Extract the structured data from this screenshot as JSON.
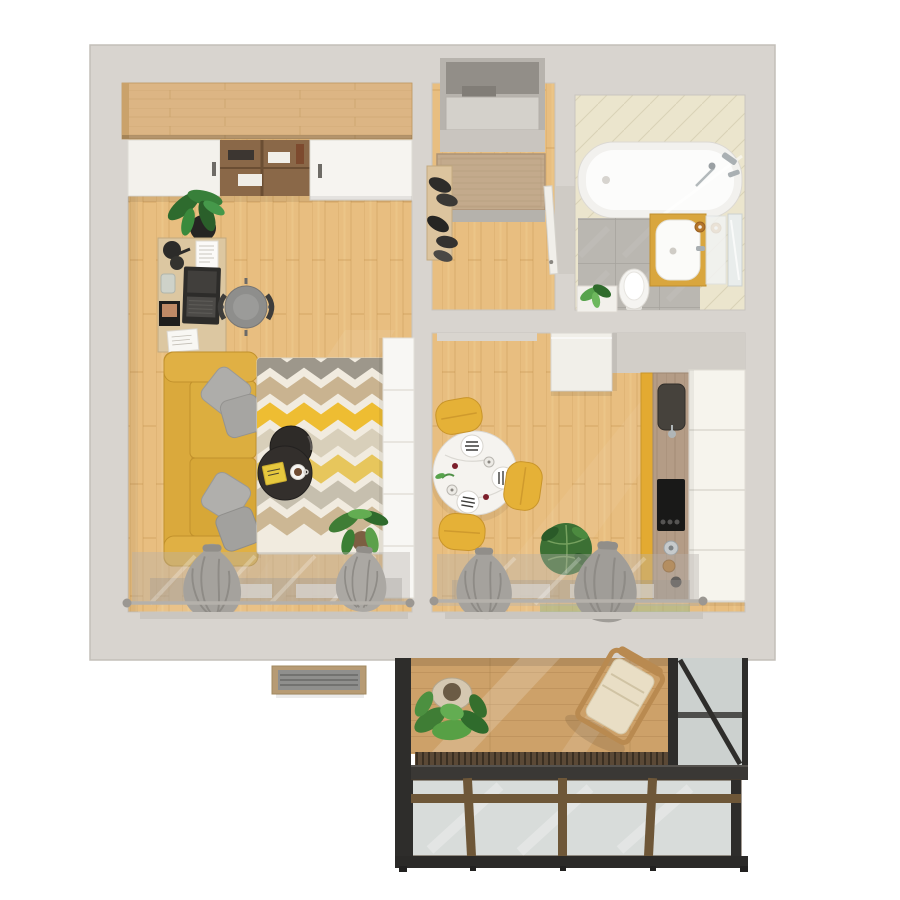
{
  "scene": {
    "title": "3D apartment floor plan render, top-down view",
    "rooms": [
      {
        "name": "living-room",
        "furniture": [
          "wardrobe-sliding-doors",
          "work-desk",
          "laptop",
          "desk-lamp",
          "office-chair",
          "potted-fern",
          "yellow-sofa",
          "gray-pillows",
          "chevron-rug",
          "nesting-coffee-tables",
          "coffee-cup",
          "yellow-book",
          "white-storage-cabinet",
          "floor-plant",
          "window-curtains",
          "curtain-rod"
        ]
      },
      {
        "name": "hallway",
        "furniture": [
          "entry-door",
          "doormat",
          "shoe-bench",
          "boots",
          "bathroom-door"
        ]
      },
      {
        "name": "bathroom",
        "furniture": [
          "bathtub",
          "shower-mixer",
          "glass-screen",
          "vanity-cabinet",
          "sink",
          "mirror",
          "toilet",
          "plant-stand"
        ]
      },
      {
        "name": "kitchen",
        "furniture": [
          "fridge",
          "round-dining-table",
          "plates",
          "wine-glasses",
          "yellow-chairs",
          "kitchen-counter",
          "kitchen-sink",
          "cooktop",
          "upper-cabinets",
          "kettle",
          "floor-plant",
          "window-curtains",
          "curtain-rod"
        ]
      },
      {
        "name": "balcony",
        "furniture": [
          "wood-deck",
          "lounge-chair",
          "potted-plant",
          "glazing-frames",
          "glass-roof"
        ]
      },
      {
        "name": "exterior",
        "furniture": [
          "ac-unit"
        ]
      }
    ]
  },
  "palette": {
    "background": "#ffffff",
    "wall": "#d8d4cf",
    "wall_stroke": "#c3bfb9",
    "floor_wood": "#e8be80",
    "wardrobe_wood": "#dcb584",
    "deck_wood": "#cda169",
    "counter_wood": "#b49c86",
    "bath_tile_floor": "#bab7b1",
    "bath_tile_wall": "#ebe5cd",
    "accent_yellow": "#e3aa31",
    "chair_yellow": "#e5b137",
    "sofa_yellow": "#dcae3f",
    "vanity_yellow": "#d9a63e",
    "rug_base": "#f1ebdf",
    "rug_stripes": [
      "#9d978b",
      "#c9b390",
      "#eebd32",
      "#d8cfba",
      "#e7c65c",
      "#c6bfae",
      "#ccb794"
    ],
    "pillow_gray": "#aeadaa",
    "curtain_gray": "#a5a29d",
    "cabinet_white": "#f8f7f4",
    "table_white": "#f5f3ef",
    "appliance_black": "#191918",
    "glass": "#d8dcda",
    "glass_side": "#ccd1cf",
    "balcony_frame": "#2e2d2b",
    "plant_green": "#3f7d35"
  }
}
